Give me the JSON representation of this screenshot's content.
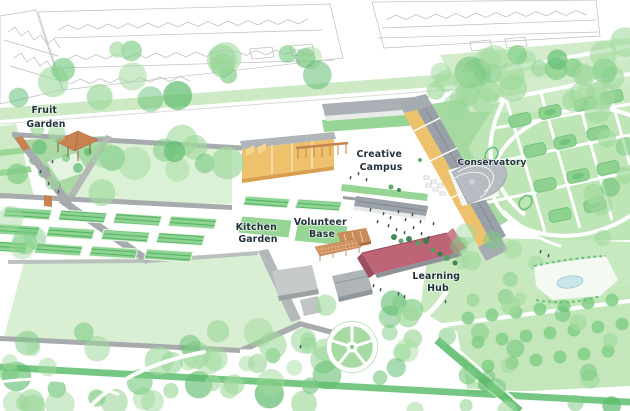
{
  "labels": {
    "fruit_garden": {
      "line1": "Fruit",
      "line2": "Garden"
    },
    "kitchen_garden": {
      "line1": "Kitchen",
      "line2": "Garden"
    },
    "volunteer_base": {
      "line1": "Volunteer",
      "line2": "Base"
    },
    "creative_campus": {
      "line1": "Creative",
      "line2": "Campus"
    },
    "conservatory": {
      "text": "Conservatory"
    },
    "learning_hub": {
      "line1": "Learning",
      "line2": "Hub"
    }
  },
  "colors": {
    "background": "#ffffff",
    "outline_gray": "#b9bfba",
    "tree_light": "#9fd99c",
    "tree_mid": "#7ccb83",
    "tree_dark": "#5dbb6d",
    "verge_green": "#cdeac5",
    "lawn_pale": "#d9efd3",
    "lawn_mid": "#97d596",
    "parterre_green": "#bde5b5",
    "bed_green": "#8ed493",
    "bed_stripe": "#57b264",
    "hedge_green": "#6cc07a",
    "path_white": "#ffffff",
    "wall_gray": "#a7abae",
    "roof_gray": "#9aa1a8",
    "building_gray": "#c2c6c6",
    "roof_orange": "#eec26d",
    "roof_orange_dark": "#d89f4f",
    "roof_terracotta": "#c8824f",
    "greenhouse_orange": "#cf8f5a",
    "roof_rose": "#bd6577",
    "roof_rose_dark": "#9c4f61",
    "pond_blue": "#c9e6ec",
    "people_dark": "#454f58",
    "label_text": "#22313c"
  }
}
